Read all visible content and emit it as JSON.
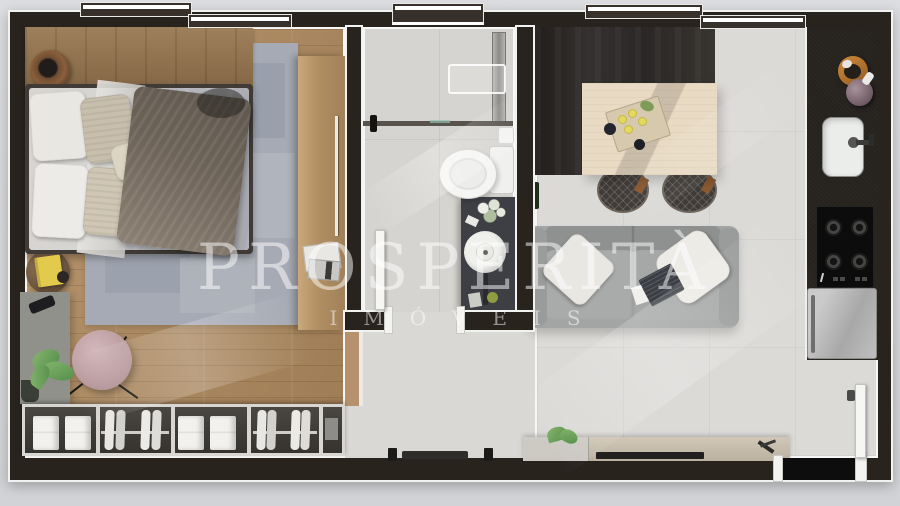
{
  "watermark": {
    "title": "PROSPERITÀ",
    "subtitle": "IMÓVEIS"
  },
  "scene": {
    "description": "Top-down 3D architectural render of a small apartment floor plan",
    "rooms": [
      {
        "name": "bedroom",
        "items": [
          "double bed with gray duvet and taupe throw",
          "patchwork gray area rug",
          "wood headboard shelf with planter basket",
          "tall wood wardrobe cabinet with magazines",
          "round rattan side table with yellow book",
          "gray desk with smartphone and monstera plant",
          "round pink lounge chair",
          "open closet with folded linens and hanging clothes"
        ]
      },
      {
        "name": "bathroom",
        "items": [
          "walk-in shower with glass partition and linear drain",
          "wall niche",
          "toilet with paper roll",
          "dark vanity with round vessel sink, flowers and candle",
          "white swing door"
        ]
      },
      {
        "name": "living-dining",
        "items": [
          "dark drapery feature wall",
          "light wood dining table with serving tray, lemons and drinks",
          "two wire-frame chairs",
          "gray sofa with white pillows and laptop",
          "media console with plant and TV",
          "soundbar and speakers"
        ]
      },
      {
        "name": "kitchen",
        "items": [
          "black countertop",
          "wooden bowl",
          "ceramic vase",
          "undermount sink with faucet",
          "4-burner cooktop",
          "refrigerator"
        ]
      },
      {
        "name": "entry",
        "items": [
          "white entrance door"
        ]
      }
    ]
  },
  "palette": {
    "page_background": "#dcdde0",
    "wall": "#29231e",
    "wall_outline": "#f2f2f1",
    "wood_floor": "#b08a5e",
    "tile_floor": "#d9d8d5",
    "rug": "#a6aab4",
    "curtain": "#312d2b",
    "counter": "#26231f",
    "sofa": "#a3a4a4",
    "chair_pink": "#c4a7aa",
    "book_yellow": "#e2ca4d",
    "plant_green": "#6fa055",
    "bowl_wood": "#c17a35",
    "watermark": "rgba(255,255,255,0.5)"
  }
}
